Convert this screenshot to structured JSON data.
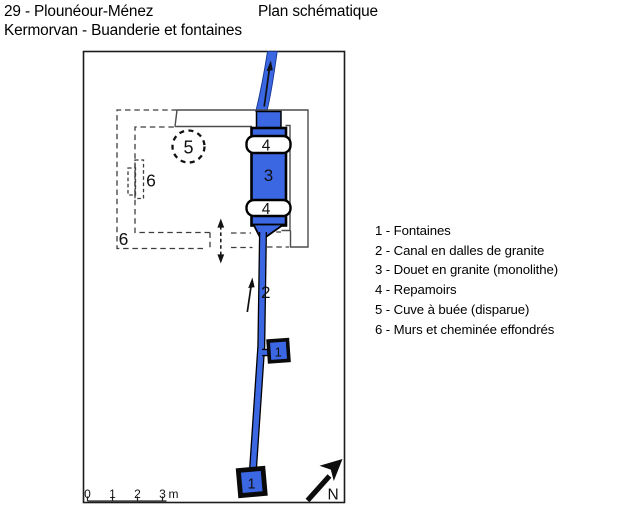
{
  "header": {
    "site_line": "29 - Plounéour-Ménez",
    "title": "Plan schématique",
    "subtitle": "Kermorvan - Buanderie et fontaines"
  },
  "legend": {
    "items": [
      "1 - Fontaines",
      "2 - Canal en dalles de granite",
      "3 - Douet en granite (monolithe)",
      "4 - Repamoirs",
      "5 - Cuve à buée (disparue)",
      "6 - Murs et cheminée effondrés"
    ]
  },
  "plan": {
    "labels": {
      "fountain_a": "1",
      "fountain_b": "1",
      "canal": "2",
      "douet": "3",
      "repamoir_top": "4",
      "repamoir_bottom": "4",
      "cuve": "5",
      "chimney": "6",
      "walls": "6",
      "north": "N"
    },
    "scale": {
      "ticks": [
        "0",
        "1",
        "2",
        "3"
      ],
      "unit": "m"
    }
  },
  "colors": {
    "water_blue": "#3B67E2",
    "wall_gray": "#4C4C4C",
    "dashed_gray": "#3D3D3D",
    "ink": "#101010"
  }
}
